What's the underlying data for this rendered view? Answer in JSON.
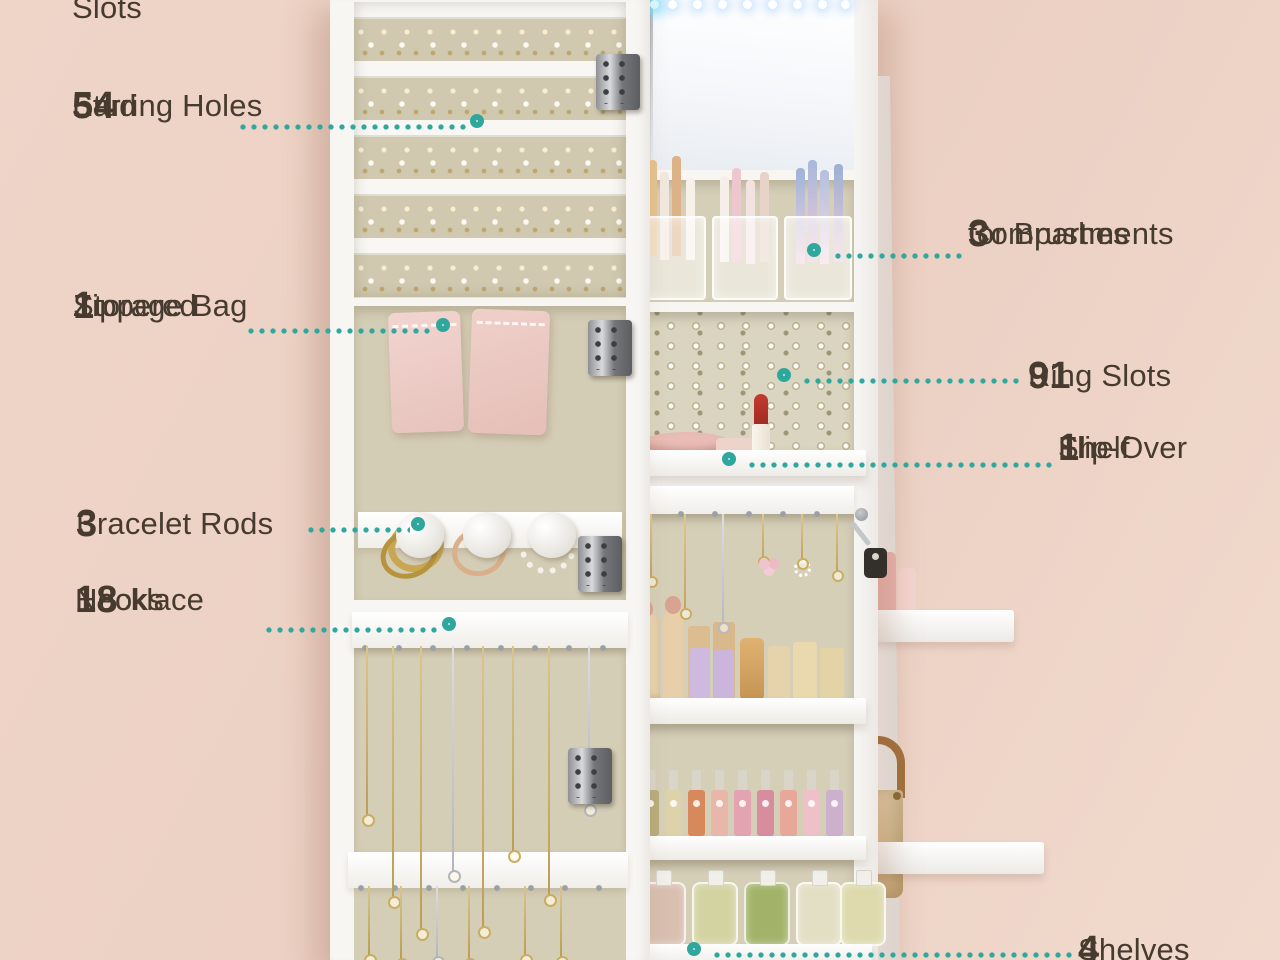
{
  "product": "jewelry-cabinet-feature-diagram",
  "colors": {
    "background": "#ecd1c4",
    "text": "#473a2f",
    "accent_teal": "#2fa79d",
    "donut_inner": "#cdeeea",
    "cabinet_white": "#f8f6f3",
    "panel_beige": "#d6cfb8"
  },
  "callouts": {
    "slots": {
      "num": "",
      "l1": "Slots",
      "l2": ""
    },
    "stud": {
      "num": "54",
      "l1": "Stud",
      "l2": "Earring Holes"
    },
    "zippered": {
      "num": "1",
      "l1": "Zippered",
      "l2": "Storage Bag"
    },
    "bracelet": {
      "num": "3",
      "l1": "Bracelet Rods",
      "l2": ""
    },
    "necklace": {
      "num": "18",
      "l1": "Necklace",
      "l2": "Hooks"
    },
    "brushes": {
      "num": "3",
      "l1": "Compartments",
      "l2": "for Brushes"
    },
    "rings": {
      "num": "91",
      "l1": "Ring Slots",
      "l2": ""
    },
    "flip": {
      "num": "1",
      "l1": "Flip-Over",
      "l2": "Shelf"
    },
    "shelves": {
      "num": "4",
      "l1": "Shelves",
      "l2": ""
    }
  }
}
